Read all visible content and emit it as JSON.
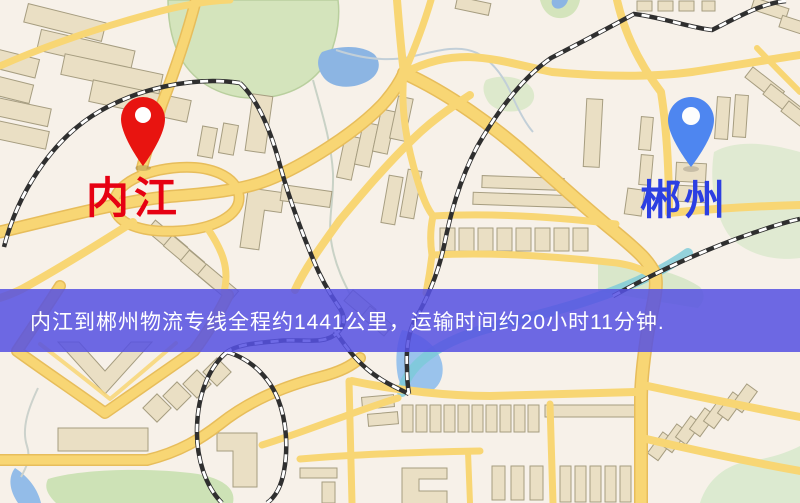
{
  "banner": {
    "text": "内江到郴州物流专线全程约1441公里，运输时间约20小时11分钟.",
    "background_color": "#5651e2",
    "text_color": "#ffffff",
    "route": {
      "origin": "内江",
      "destination": "郴州",
      "distance_km": "1441",
      "duration": "20小时11分钟"
    }
  },
  "markers": {
    "origin": {
      "label": "内江",
      "pin_color": "#e81410",
      "label_color": "#e60012"
    },
    "destination": {
      "label": "郴州",
      "pin_color": "#4e86f0",
      "label_color": "#2c3fe2"
    }
  },
  "map_colors": {
    "background": "#f7f1e9",
    "building_fill": "#eadfc4",
    "building_stroke": "#a69d80",
    "road_yellow": "#f8d674",
    "road_casing": "#e7bd5b",
    "railway_dark": "#2f2f2f",
    "park_green": "#d4e4bc",
    "forest_green": "#e0ead2",
    "field_green": "#cde2b6",
    "water_blue": "#93bce8",
    "stream_teal": "#7bcbd8"
  }
}
